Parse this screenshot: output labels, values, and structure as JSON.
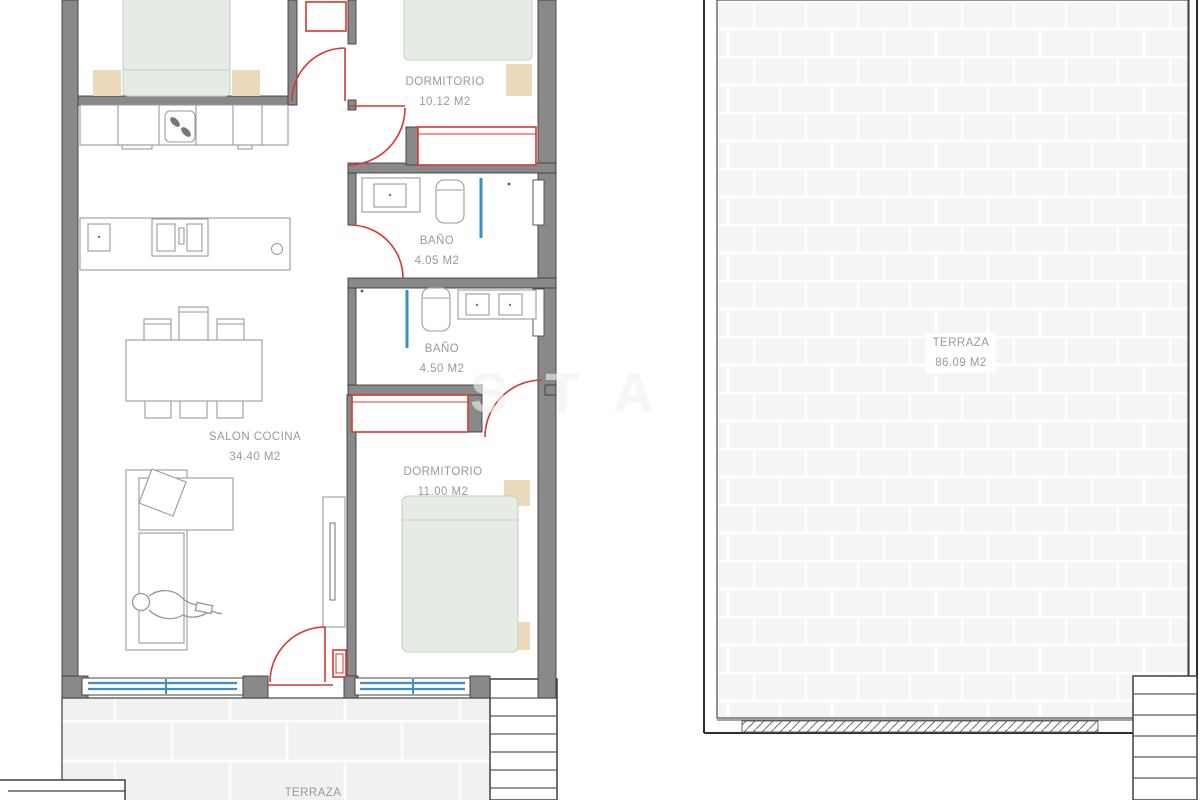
{
  "document": {
    "type": "apartment floor plan"
  },
  "rooms": {
    "dormitorio_1": {
      "name": "DORMITORIO",
      "area": "10.12 M2"
    },
    "bano_1": {
      "name": "BAÑO",
      "area": "4.05 M2"
    },
    "bano_2": {
      "name": "BAÑO",
      "area": "4.50 M2"
    },
    "salon_cocina": {
      "name": "SALON COCINA",
      "area": "34.40 M2"
    },
    "dormitorio_2": {
      "name": "DORMITORIO",
      "area": "11.00 M2"
    },
    "terraza_main": {
      "name": "TERRAZA",
      "area": "86.09 M2"
    },
    "terraza_lower": {
      "name": "TERRAZA"
    }
  },
  "watermark": "STA",
  "colors": {
    "wall_gray": "#898989",
    "door_red": "#d9372e",
    "window_blue": "#3c8fc0",
    "bed_green": "#e4ece3",
    "wood_tan": "#ecd9bc",
    "tile_light": "#f4f4f4",
    "label_gray": "#9a9a9a"
  }
}
